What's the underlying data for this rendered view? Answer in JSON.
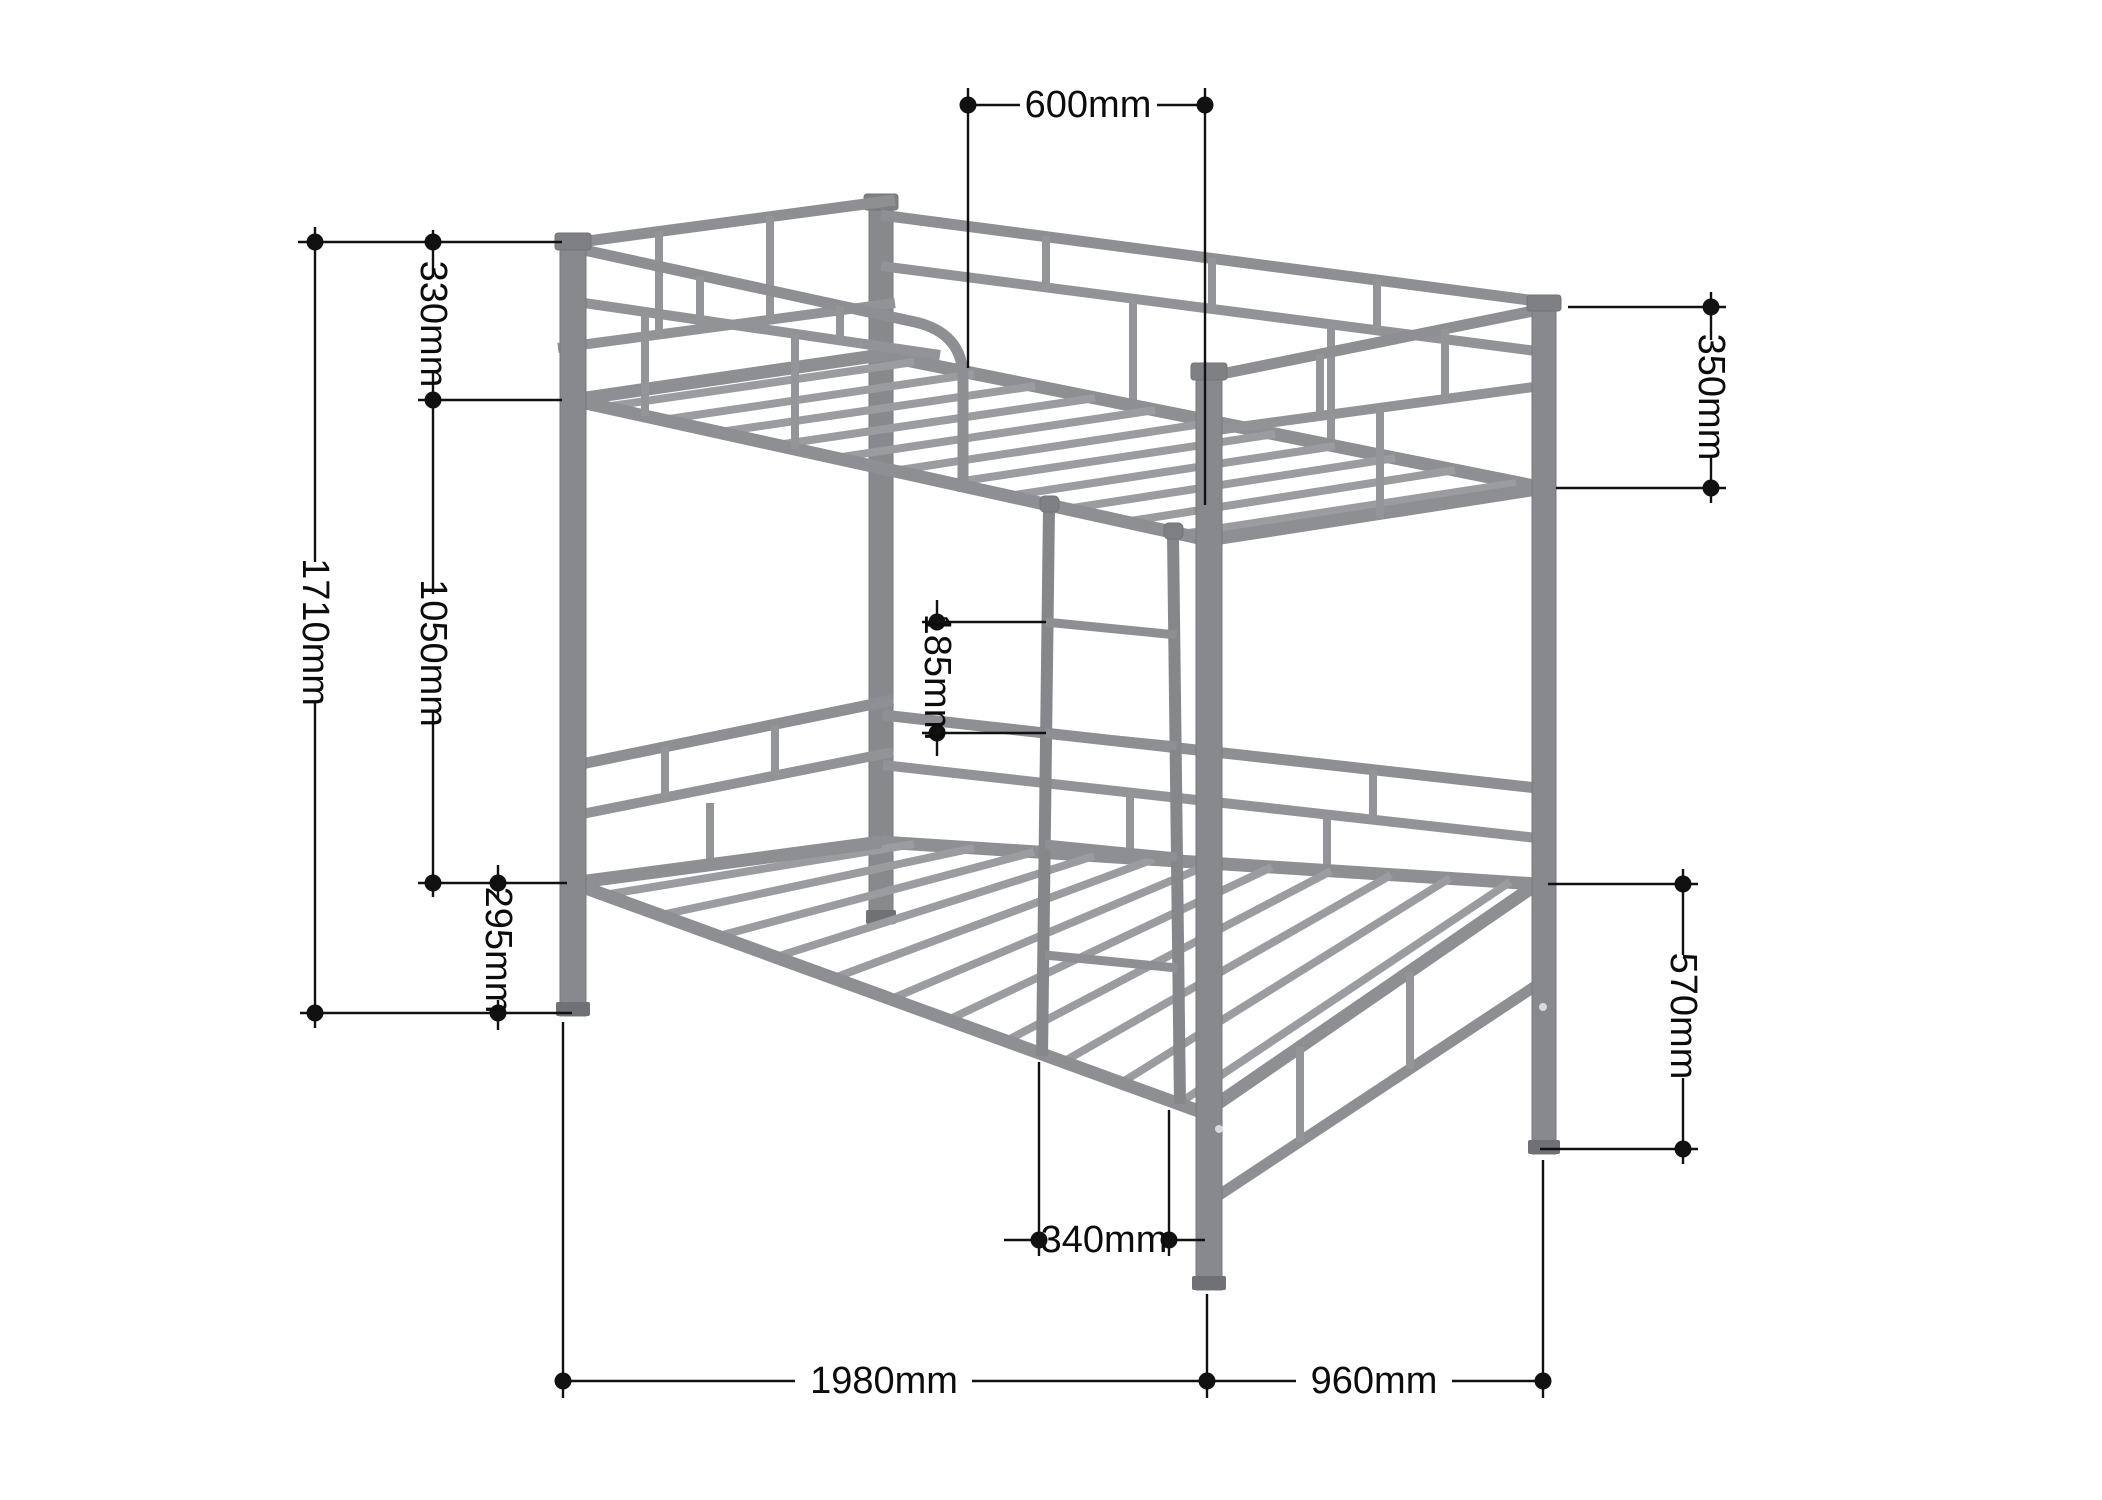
{
  "diagram": {
    "subject": "metal bunk bed with dimension annotations",
    "colors": {
      "background": "#ffffff",
      "frame_gray": "#8d8f92",
      "frame_light": "#9a9c9f",
      "post_gray": "#87898c",
      "dimension_black": "#111111"
    },
    "annotations": {
      "top_opening_width": "600mm",
      "left_guard_height": "330mm",
      "left_bunk_gap": "1050mm",
      "left_overall_height": "1710mm",
      "left_lower_rail_height": "295mm",
      "right_guard_height": "350mm",
      "right_lower_frame_height": "570mm",
      "ladder_rung_spacing": "185mm",
      "ladder_width": "340mm",
      "bottom_length": "1980mm",
      "bottom_depth": "960mm"
    }
  }
}
